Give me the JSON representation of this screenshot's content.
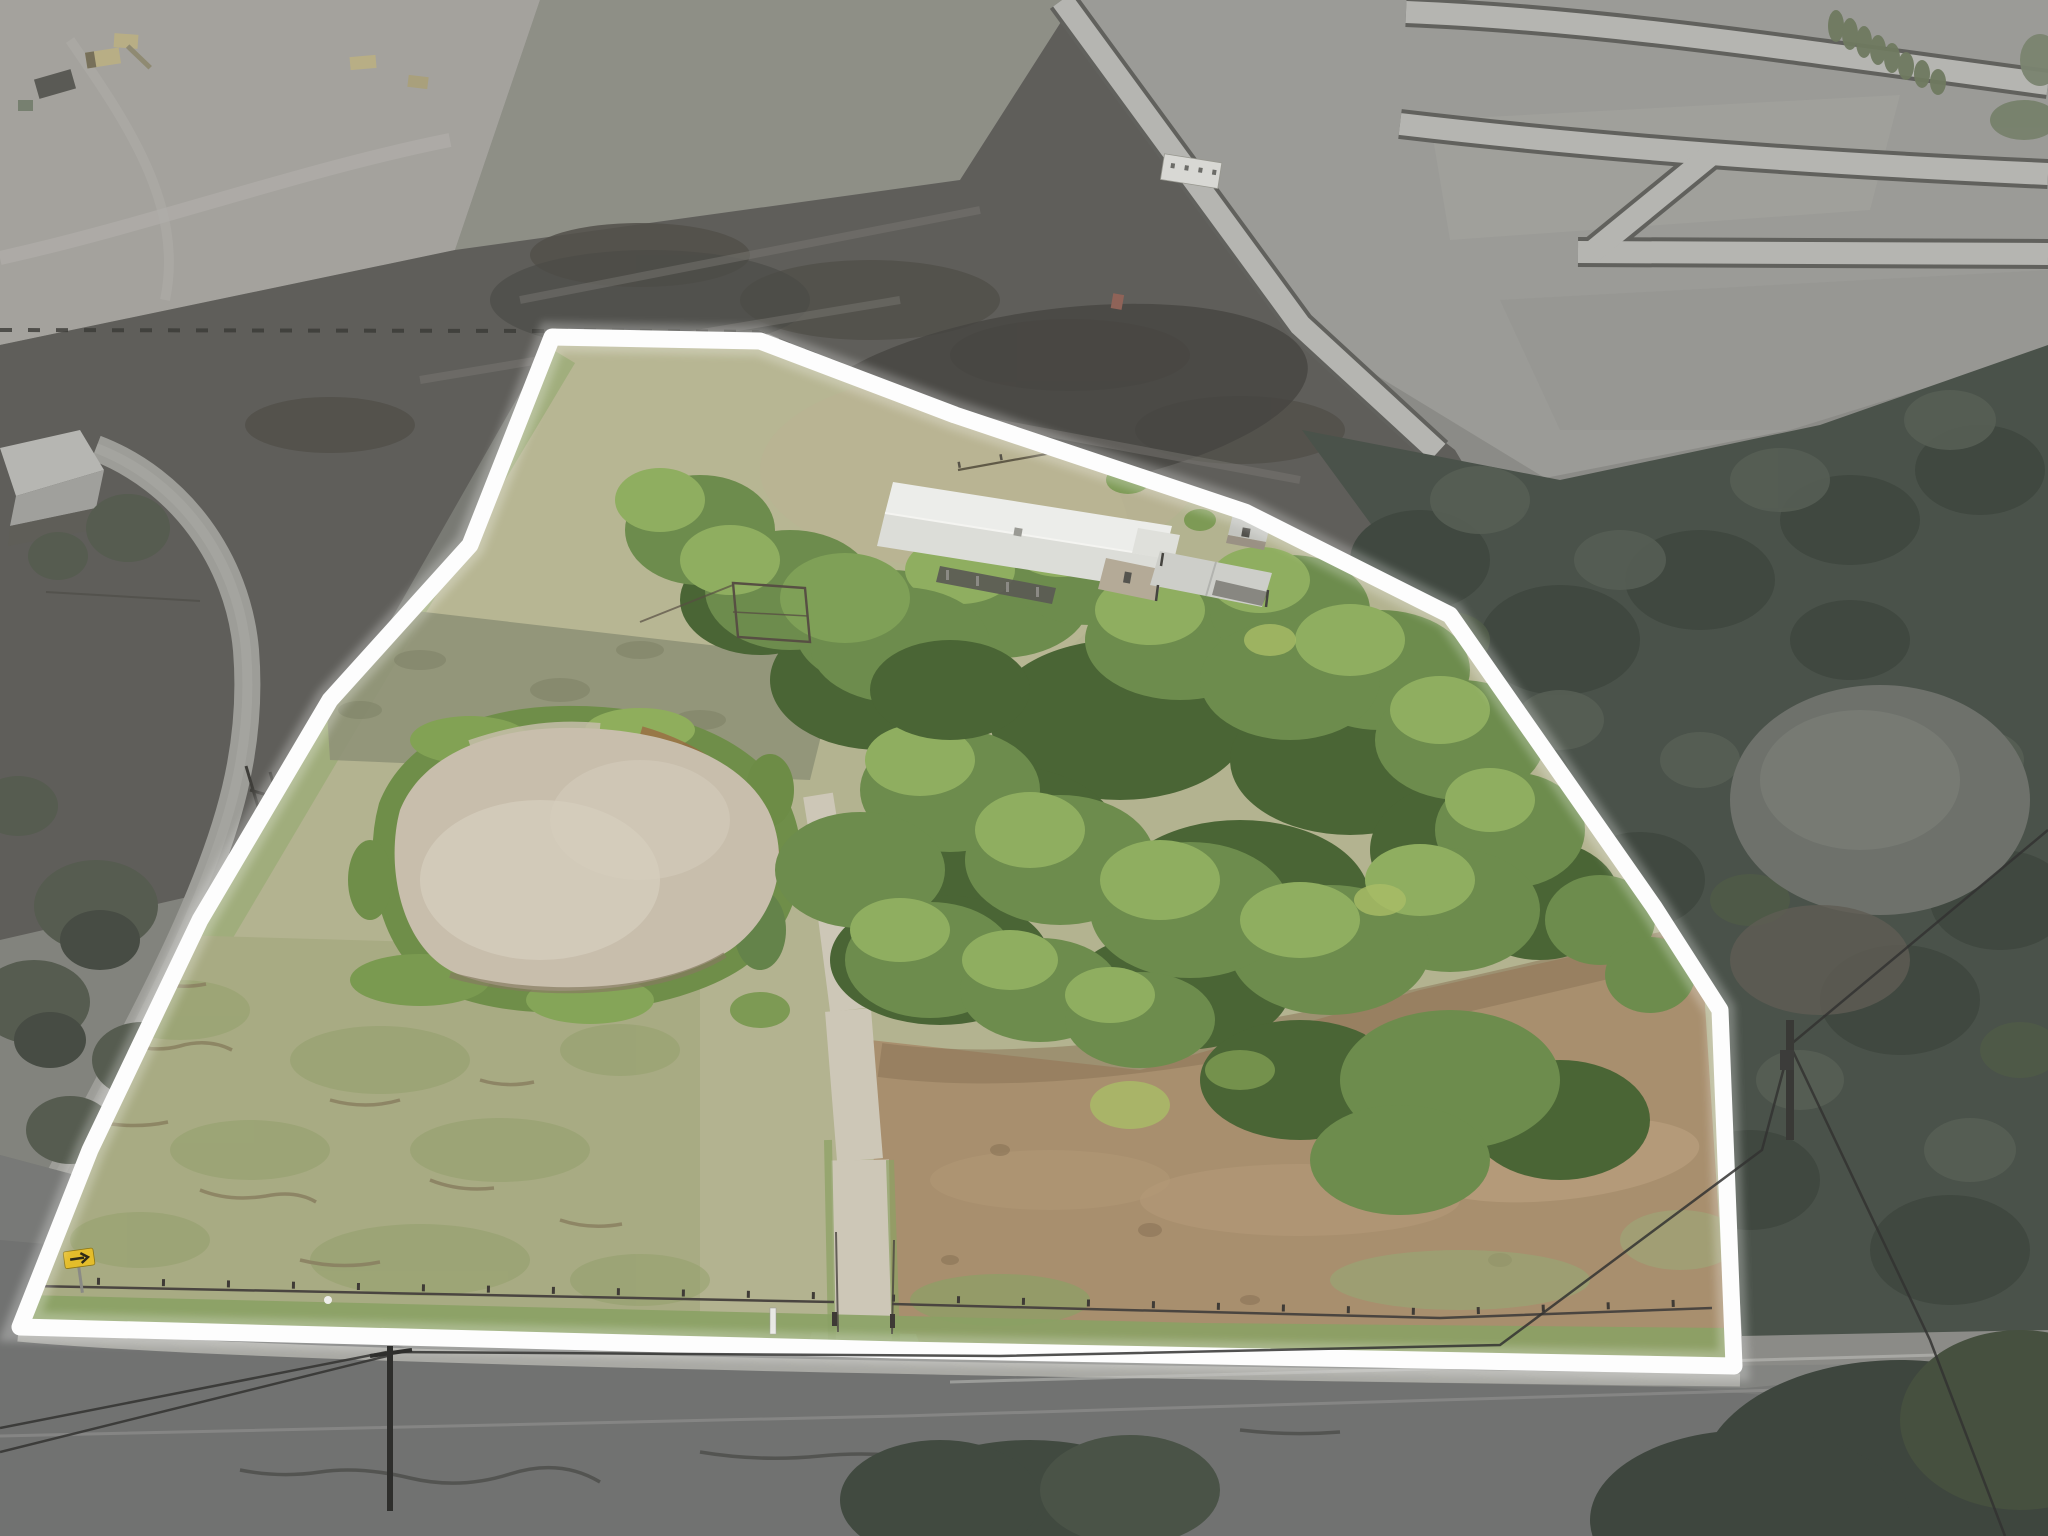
{
  "scene": {
    "type": "aerial-drone-photograph",
    "subject": "Rural homestead lot outlined in white; surrounding land desaturated to highlight the parcel",
    "style": "real-estate listing aerial"
  },
  "boundary": {
    "points": "552,337 760,341 955,415 1245,512 1450,615 1654,907 1720,1010 1734,1366 900,1350 20,1327 90,1150 200,920 330,700 470,545",
    "stroke_color": "#fdfdfd",
    "stroke_width": "17",
    "glow_width": "30"
  },
  "colors": {
    "base": "#8b8b87",
    "construction_dirt_light": "#a4a29d",
    "olive_field": "#8e8f86",
    "construction_dirt": "#5f5e5a",
    "subdivision_ground": "#9b9b97",
    "subdivision_road": "#b5b5b1",
    "subdivision_curb": "#61615d",
    "office_trailer": "#d8d8d4",
    "outside_trees": "#4a524a",
    "left_field": "#797a74",
    "asphalt": "#717271",
    "shoulder": "#a9a9a4",
    "lot_grass": "#b3b390",
    "lower_pasture": "#a8ab83",
    "pond_water": "#c8beac",
    "pond_fringe": "#6f8e49",
    "mud_rust": "#9a6a42",
    "canopy_dark": "#4a6535",
    "canopy_mid": "#6d8c4d",
    "canopy_light": "#8fae60",
    "canopy_accent": "#a9bd67",
    "house_roof": "#ecedea",
    "house_roof_shade": "#dcddd8",
    "stone_wall": "#b4aa97",
    "carport_roof": "#cdcec9",
    "shed_roof": "#c3c4bf",
    "driveway": "#cdc7b7",
    "dirt_yard": "#a88f6e",
    "fence": "#4a4540",
    "sign_yellow": "#e4bd2b",
    "machine_yellow": "#b8ae85",
    "wire": "#333331",
    "neighbor_roof": "#b6b6b2"
  },
  "features": {
    "property": "fenced homestead lot highlighted with white outline",
    "farmhouse": "stone farmhouse with white metal gable roof and shaded front porch",
    "carport": "detached metal carport east of the house",
    "shed": "small stone well-house near the carport",
    "pond": "muddy tan stock pond ringed by green vegetation",
    "driveway": "light gravel drive running from the road up through the trees",
    "tree_canopy": "dense green tree cover over the east half of the lot",
    "pastures": "dry cracked grass pastures west and south of the pond",
    "perimeter_fence": "wire fence with posts along the road frontage",
    "arrow_sign": "yellow right-arrow traffic sign at the southwest corner",
    "surroundings": "desaturated graded construction dirt with machinery, new subdivision streets, neighboring farmhouse, asphalt road with power lines, dark woods"
  }
}
